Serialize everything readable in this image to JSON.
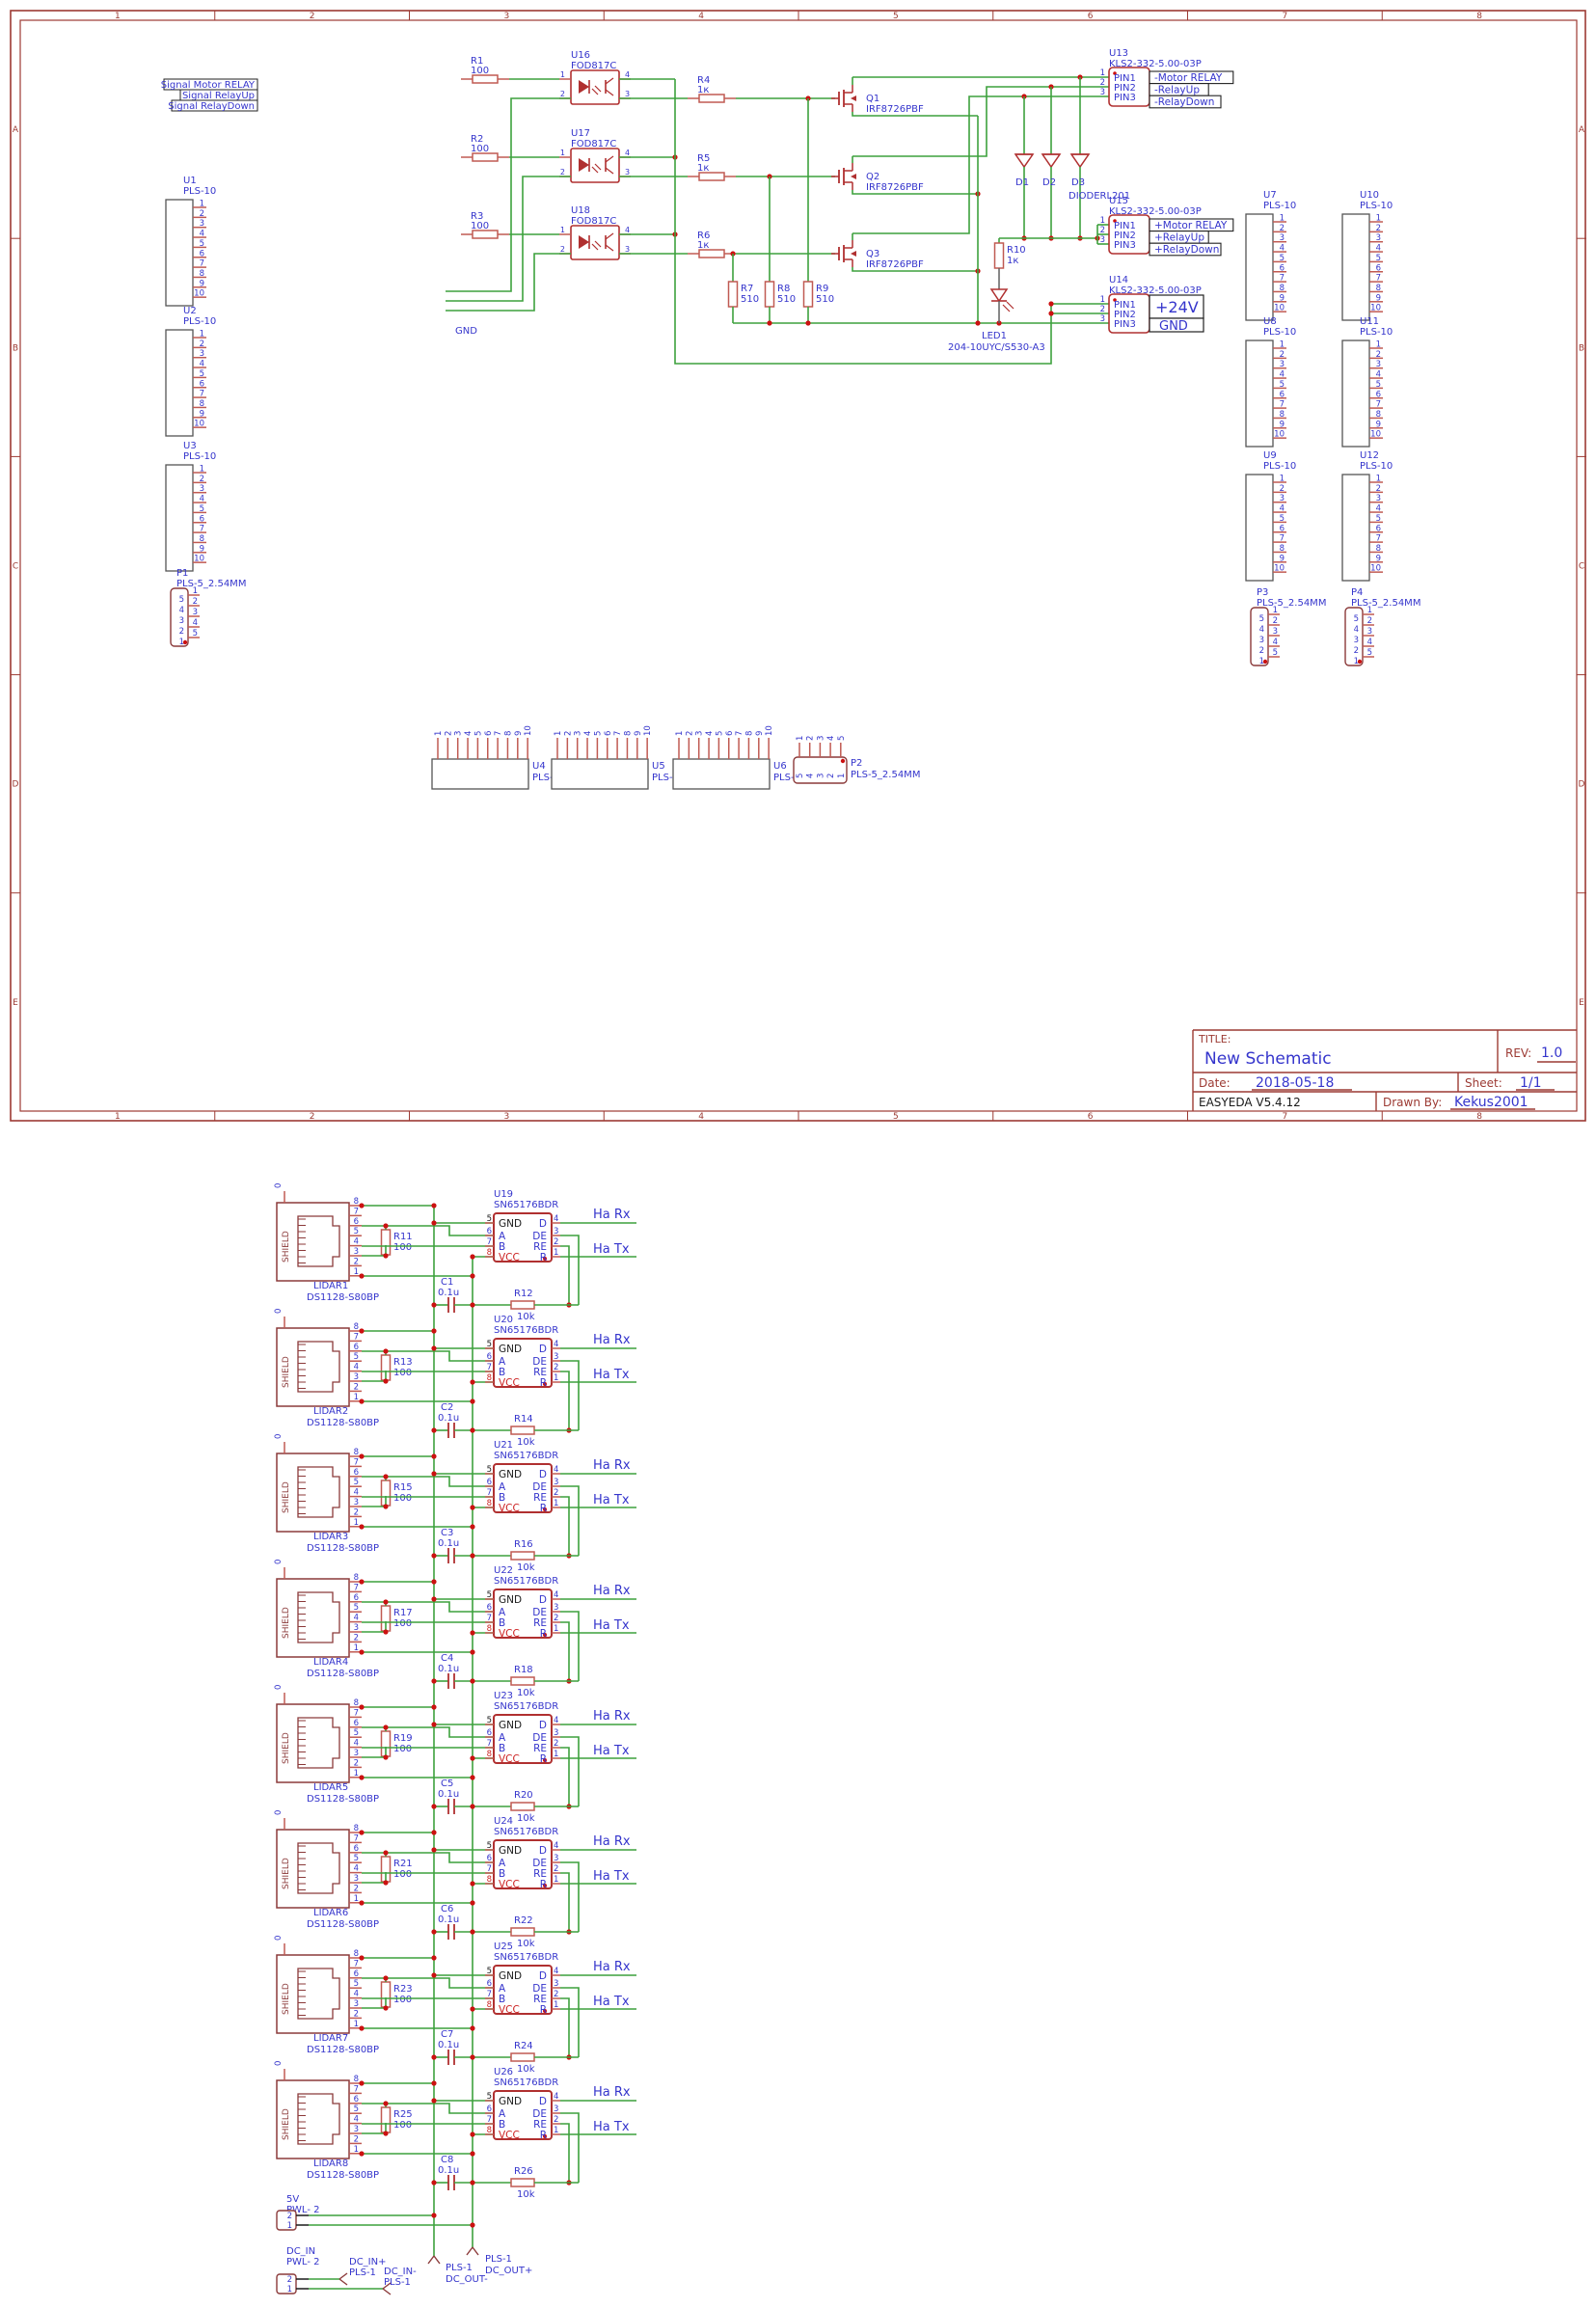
{
  "sheet": {
    "border": {
      "columns": [
        "1",
        "2",
        "3",
        "4",
        "5",
        "6",
        "7",
        "8"
      ],
      "rows": [
        "A",
        "B",
        "C",
        "D",
        "E"
      ]
    },
    "title_block": {
      "title_label": "TITLE:",
      "title": "New Schematic",
      "rev_label": "REV:",
      "rev": "1.0",
      "date_label": "Date:",
      "date": "2018-05-18",
      "sheet_label": "Sheet:",
      "sheet": "1/1",
      "software": "EASYEDA V5.4.12",
      "drawn_by_label": "Drawn By:",
      "drawn_by": "Kekus2001"
    }
  },
  "signal_labels": [
    "Signal Motor RELAY",
    "Signal RelayUp",
    "Signal RelayDown"
  ],
  "gnd_label": "GND",
  "driver_rows": [
    {
      "r_in": "R1",
      "r_in_val": "100",
      "opto": "U16",
      "opto_part": "FOD817C",
      "r_gate": "R4",
      "r_gate_val": "1к",
      "q": "Q1",
      "q_part": "IRF8726PBF"
    },
    {
      "r_in": "R2",
      "r_in_val": "100",
      "opto": "U17",
      "opto_part": "FOD817C",
      "r_gate": "R5",
      "r_gate_val": "1к",
      "q": "Q2",
      "q_part": "IRF8726PBF"
    },
    {
      "r_in": "R3",
      "r_in_val": "100",
      "opto": "U18",
      "opto_part": "FOD817C",
      "r_gate": "R6",
      "r_gate_val": "1к",
      "q": "Q3",
      "q_part": "IRF8726PBF"
    }
  ],
  "pull_resistors": [
    {
      "ref": "R7",
      "val": "510"
    },
    {
      "ref": "R8",
      "val": "510"
    },
    {
      "ref": "R9",
      "val": "510"
    }
  ],
  "diodes": {
    "refs": [
      "D1",
      "D2",
      "D3"
    ],
    "part": "DIODERL201"
  },
  "r10": {
    "ref": "R10",
    "val": "1к"
  },
  "led": {
    "ref": "LED1",
    "part": "204-10UYC/S530-A3"
  },
  "terminal_blocks": [
    {
      "ref": "U13",
      "part": "KLS2-332-5.00-03P",
      "pins": [
        "PIN1",
        "PIN2",
        "PIN3"
      ],
      "pin_nums": [
        "1",
        "2",
        "3"
      ],
      "nets": [
        "-Motor RELAY",
        "-RelayUp",
        "-RelayDown"
      ]
    },
    {
      "ref": "U15",
      "part": "KLS2-332-5.00-03P",
      "pins": [
        "PIN1",
        "PIN2",
        "PIN3"
      ],
      "pin_nums": [
        "1",
        "2",
        "3"
      ],
      "nets": [
        "+Motor RELAY",
        "+RelayUp",
        "+RelayDown"
      ]
    },
    {
      "ref": "U14",
      "part": "KLS2-332-5.00-03P",
      "pins": [
        "PIN1",
        "PIN2",
        "PIN3"
      ],
      "pin_nums": [
        "1",
        "2",
        "3"
      ],
      "nets_big": [
        "+24V",
        "GND"
      ]
    }
  ],
  "pls10": {
    "part": "PLS-10",
    "pins": [
      "1",
      "2",
      "3",
      "4",
      "5",
      "6",
      "7",
      "8",
      "9",
      "10"
    ],
    "left": [
      "U1",
      "U2",
      "U3"
    ],
    "right_col1": [
      "U7",
      "U8",
      "U9"
    ],
    "right_col2": [
      "U10",
      "U11",
      "U12"
    ],
    "bottom": [
      "U4",
      "U5",
      "U6"
    ]
  },
  "pls5": {
    "part": "PLS-5_2.54MM",
    "inner_pins": [
      "5",
      "4",
      "3",
      "2",
      "1"
    ],
    "outer_pins": [
      "1",
      "2",
      "3",
      "4",
      "5"
    ],
    "left": "P1",
    "bottom": "P2",
    "right": [
      "P3",
      "P4"
    ]
  },
  "lidar_section": {
    "rj45": {
      "shield": "SHIELD",
      "shield_pin": "0",
      "pins": [
        "8",
        "7",
        "6",
        "5",
        "4",
        "3",
        "2",
        "1"
      ]
    },
    "xcvr_left_pins": [
      {
        "num": "5",
        "name": "GND"
      },
      {
        "num": "6",
        "name": "A"
      },
      {
        "num": "7",
        "name": "B"
      },
      {
        "num": "8",
        "name": "VCC"
      }
    ],
    "xcvr_right_pins": [
      {
        "num": "4",
        "name": "D"
      },
      {
        "num": "3",
        "name": "DE"
      },
      {
        "num": "2",
        "name": "RE"
      },
      {
        "num": "1",
        "name": "R"
      }
    ],
    "channels": [
      {
        "lidar": "LIDAR1",
        "part": "DS1128-S80BP",
        "r_term": "R11",
        "r_term_val": "100",
        "cap": "C1",
        "cap_val": "0.1u",
        "r_bias": "R12",
        "r_bias_val": "10k",
        "ic": "U19",
        "ic_part": "SN65176BDR",
        "rx": "Ha Rx",
        "tx": "Ha Tx"
      },
      {
        "lidar": "LIDAR2",
        "part": "DS1128-S80BP",
        "r_term": "R13",
        "r_term_val": "100",
        "cap": "C2",
        "cap_val": "0.1u",
        "r_bias": "R14",
        "r_bias_val": "10k",
        "ic": "U20",
        "ic_part": "SN65176BDR",
        "rx": "Ha Rx",
        "tx": "Ha Tx"
      },
      {
        "lidar": "LIDAR3",
        "part": "DS1128-S80BP",
        "r_term": "R15",
        "r_term_val": "100",
        "cap": "C3",
        "cap_val": "0.1u",
        "r_bias": "R16",
        "r_bias_val": "10k",
        "ic": "U21",
        "ic_part": "SN65176BDR",
        "rx": "Ha Rx",
        "tx": "Ha Tx"
      },
      {
        "lidar": "LIDAR4",
        "part": "DS1128-S80BP",
        "r_term": "R17",
        "r_term_val": "100",
        "cap": "C4",
        "cap_val": "0.1u",
        "r_bias": "R18",
        "r_bias_val": "10k",
        "ic": "U22",
        "ic_part": "SN65176BDR",
        "rx": "Ha Rx",
        "tx": "Ha Tx"
      },
      {
        "lidar": "LIDAR5",
        "part": "DS1128-S80BP",
        "r_term": "R19",
        "r_term_val": "100",
        "cap": "C5",
        "cap_val": "0.1u",
        "r_bias": "R20",
        "r_bias_val": "10k",
        "ic": "U23",
        "ic_part": "SN65176BDR",
        "rx": "Ha Rx",
        "tx": "Ha Tx"
      },
      {
        "lidar": "LIDAR6",
        "part": "DS1128-S80BP",
        "r_term": "R21",
        "r_term_val": "100",
        "cap": "C6",
        "cap_val": "0.1u",
        "r_bias": "R22",
        "r_bias_val": "10k",
        "ic": "U24",
        "ic_part": "SN65176BDR",
        "rx": "Ha Rx",
        "tx": "Ha Tx"
      },
      {
        "lidar": "LIDAR7",
        "part": "DS1128-S80BP",
        "r_term": "R23",
        "r_term_val": "100",
        "cap": "C7",
        "cap_val": "0.1u",
        "r_bias": "R24",
        "r_bias_val": "10k",
        "ic": "U25",
        "ic_part": "SN65176BDR",
        "rx": "Ha Rx",
        "tx": "Ha Tx"
      },
      {
        "lidar": "LIDAR8",
        "part": "DS1128-S80BP",
        "r_term": "R25",
        "r_term_val": "100",
        "cap": "C8",
        "cap_val": "0.1u",
        "r_bias": "R26",
        "r_bias_val": "10k",
        "ic": "U26",
        "ic_part": "SN65176BDR",
        "rx": "Ha Rx",
        "tx": "Ha Tx"
      }
    ],
    "power": {
      "v5": {
        "name": "5V",
        "part": "PWL- 2",
        "pins": [
          "2",
          "1"
        ]
      },
      "dcin": {
        "name": "DC_IN",
        "part": "PWL- 2",
        "pins": [
          "2",
          "1"
        ]
      },
      "dc_in_plus": {
        "name": "DC_IN+",
        "part": "PLS-1"
      },
      "dc_in_minus": {
        "name": "DC_IN-",
        "part": "PLS-1"
      },
      "dc_out_minus": {
        "name": "DC_OUT-",
        "part": "PLS-1"
      },
      "dc_out_plus": {
        "name": "DC_OUT+",
        "part": "PLS-1"
      }
    }
  },
  "colors": {
    "wire": "#3da13d",
    "frame": "#9c3a33",
    "component": "#b03030",
    "component_soft": "#c05a52",
    "connector": "#8b3a3a",
    "gray_box": "#555555",
    "label": "#3535cc",
    "junction": "#cc1111",
    "black": "#1a1a1a",
    "vcc": "#cc2222",
    "net_box": "#222222",
    "gray_wire": "#606060"
  }
}
